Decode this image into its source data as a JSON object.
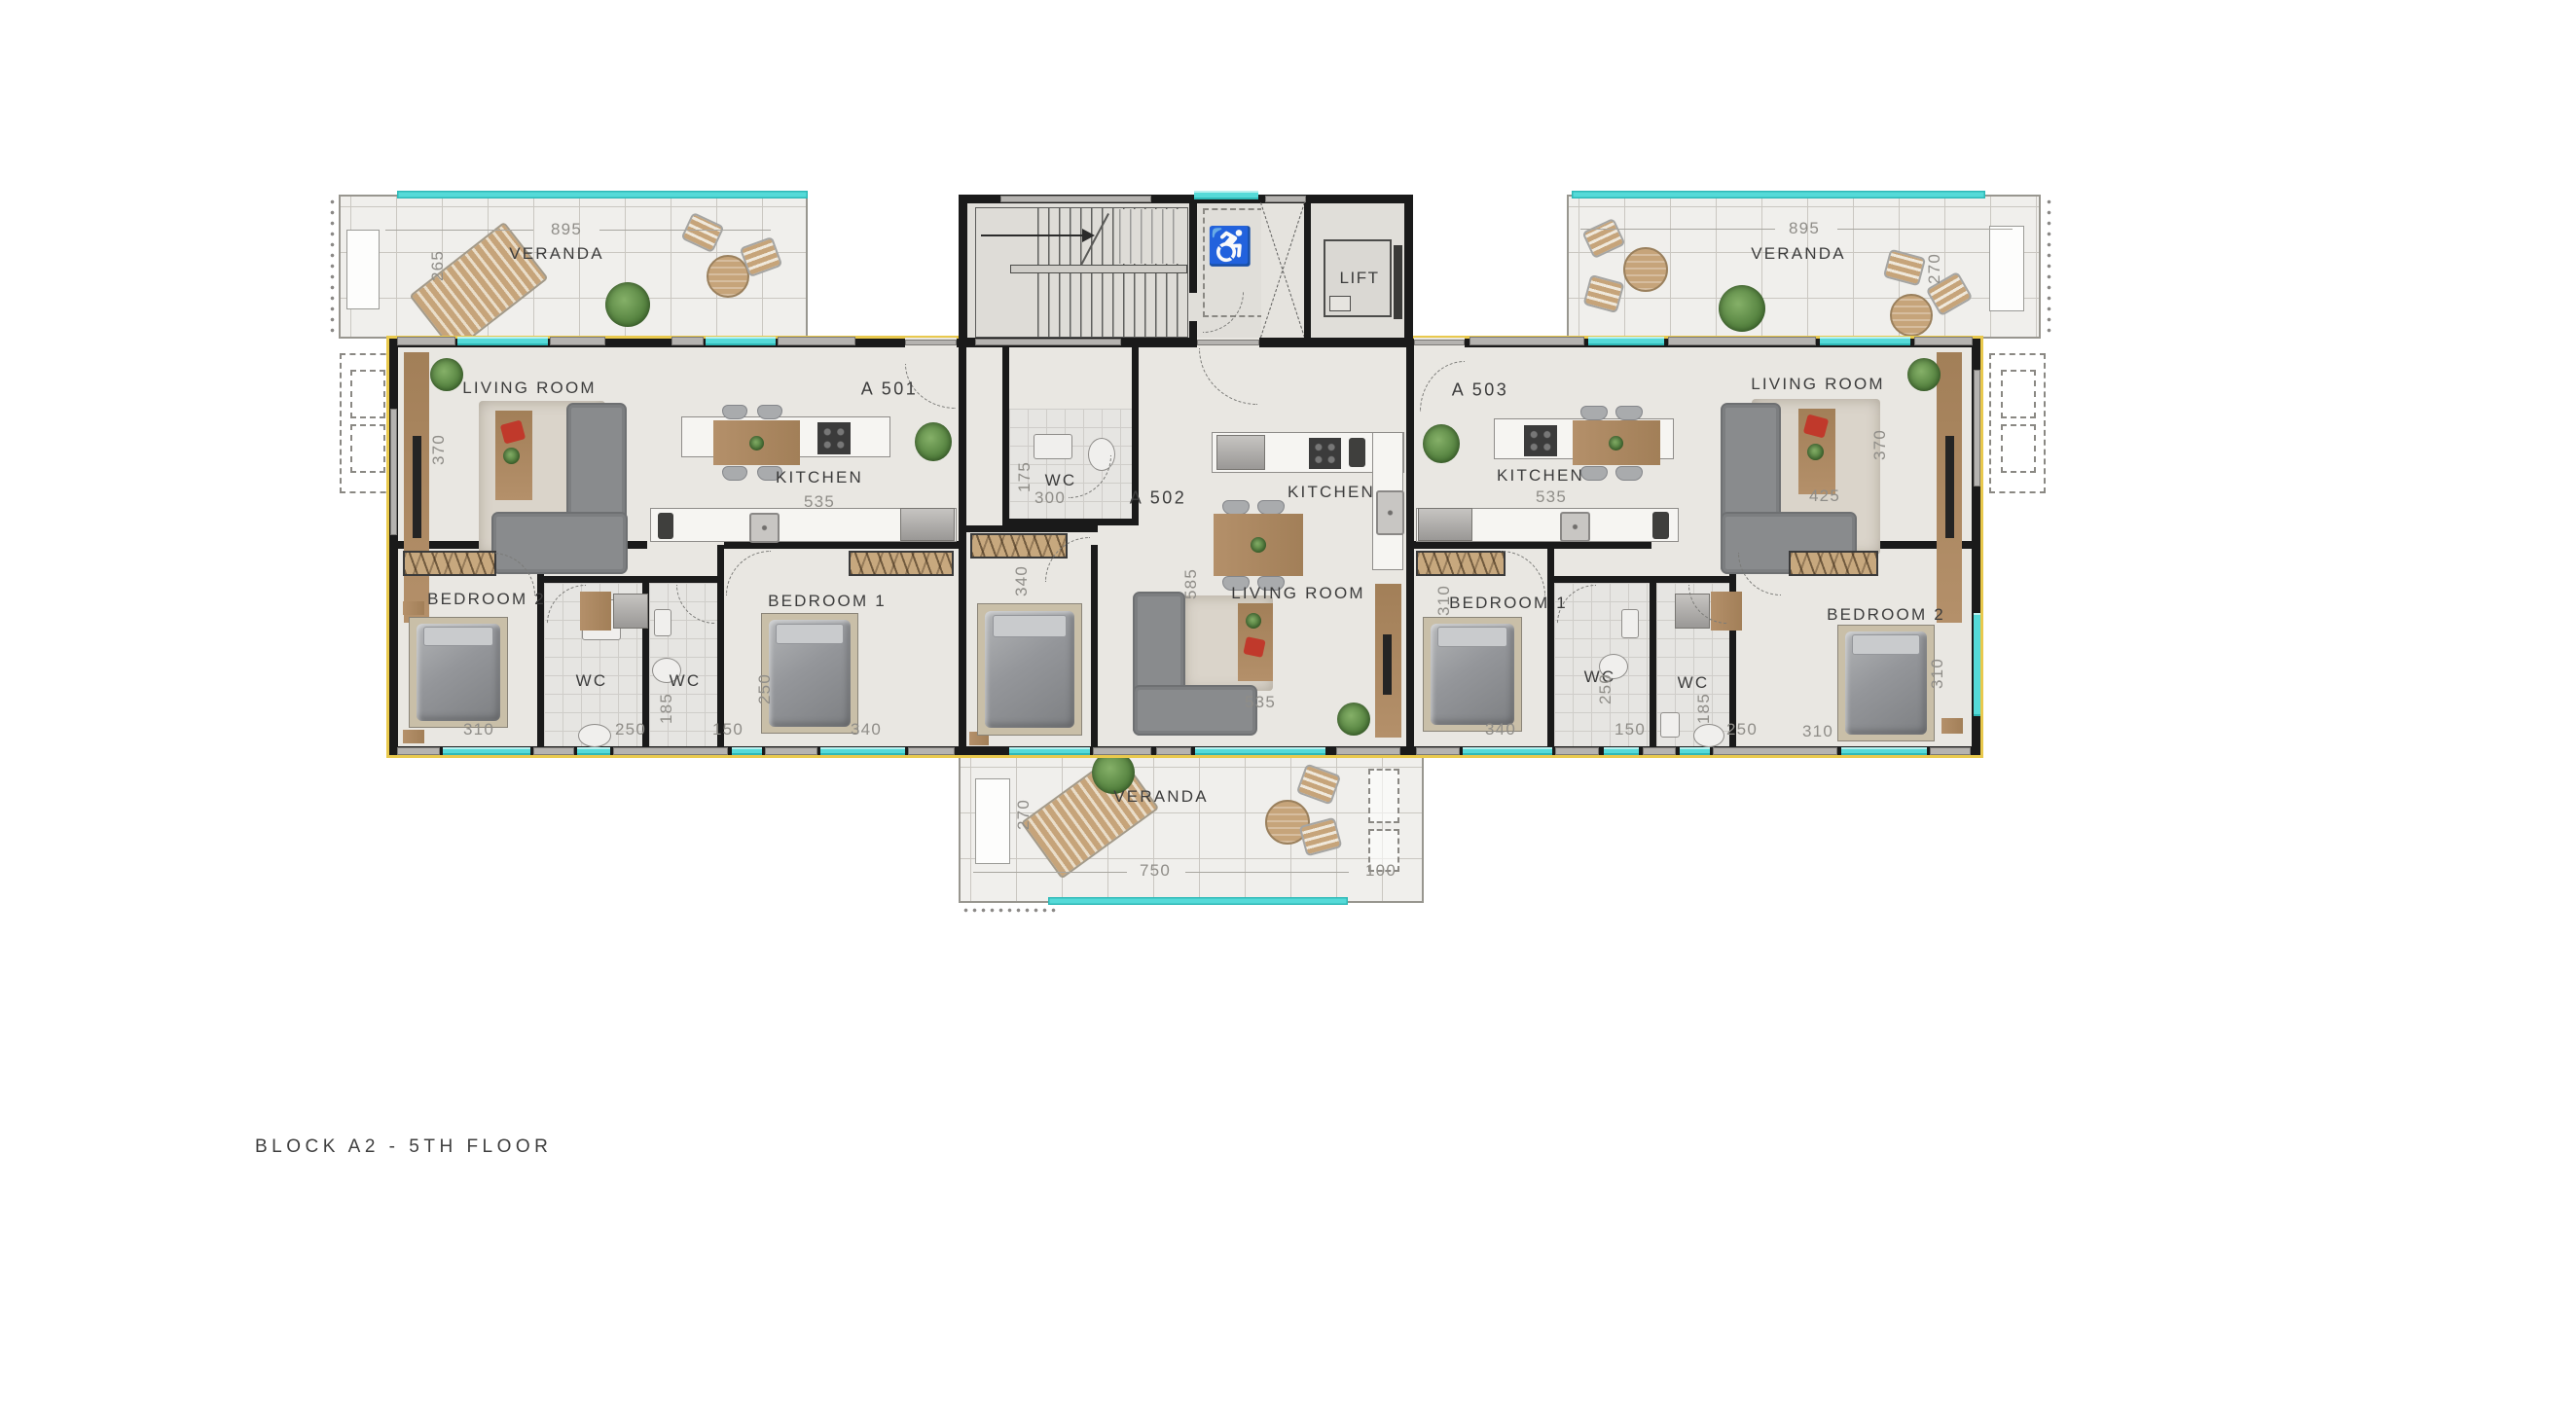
{
  "title": "BLOCK A2 - 5TH FLOOR",
  "apartments": {
    "a501": "A 501",
    "a502": "A 502",
    "a503": "A 503"
  },
  "rooms": {
    "living_room": "LIVING ROOM",
    "kitchen": "KITCHEN",
    "bedroom1": "BEDROOM 1",
    "bedroom2": "BEDROOM 2",
    "wc": "WC",
    "veranda": "VERANDA",
    "lift": "LIFT"
  },
  "icons": {
    "wheelchair": "♿"
  },
  "dims": {
    "d100": "100",
    "d150": "150",
    "d175": "175",
    "d185": "185",
    "d250": "250",
    "d265": "265",
    "d270": "270",
    "d300": "300",
    "d310": "310",
    "d340": "340",
    "d370": "370",
    "d425": "425",
    "d535": "535",
    "d585": "585",
    "d750": "750",
    "d895": "895"
  },
  "colors": {
    "wall": "#1a1a1a",
    "accent_yellow": "#e9c94d",
    "glass_cyan": "#55dad8",
    "floor": "#e9e7e2",
    "veranda_floor": "#f0efec",
    "wood": "#b08a5f",
    "sofa_gray": "#898b8d",
    "dim_text": "#8f8d88",
    "label_text": "#3c3c3c"
  }
}
